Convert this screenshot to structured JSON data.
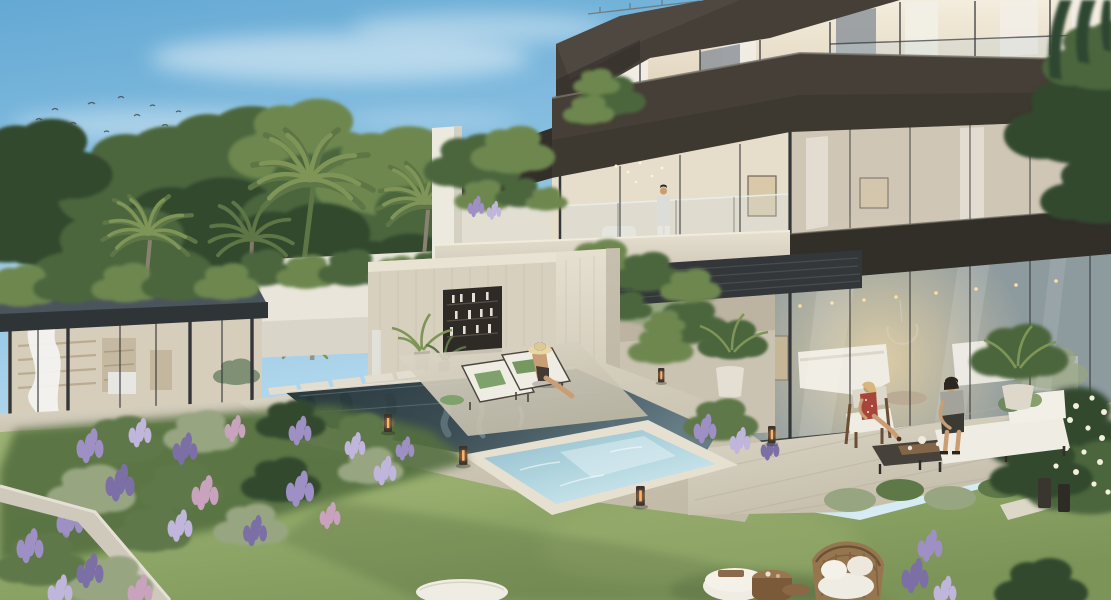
{
  "scene": {
    "description": "Dusk architectural rendering of a modern three-storey villa with floor-to-ceiling glazing and dark bronze fascia bands, a travertine pool house with display niche, a glass garden pavilion with billowing white curtain, a dark reflective pool, a raised light-blue jacuzzi, terraced lavender flower beds, manicured lawn and outdoor lounge furniture.",
    "setting": {
      "time_of_day": "dusk",
      "weather": "clear sky with thin cirrus clouds",
      "birds_in_sky": 13
    },
    "architecture": {
      "main_villa": {
        "floors": 3,
        "facade": "glass with dark bronze fascia bands",
        "interior_lights": "on",
        "middle_floor": "glass-railed balcony"
      },
      "pool_house": {
        "material": "travertine",
        "feature": "recessed shelving niche with bottles"
      },
      "portal": {
        "material": "travertine",
        "feature": "dark louvred canopy with climbing vine"
      },
      "garden_pavilion": {
        "type": "glass cabana",
        "roof": "dark flat slab",
        "detail": "white sheer curtain"
      }
    },
    "landscape": {
      "palm_trees": 6,
      "flower_beds": "lavender, sage and pink perennials in terraced concrete planters",
      "lawn": "manicured green",
      "corner_bush": "white frangipani"
    },
    "water_features": {
      "pool": "dark reflective pool with wall waterfall",
      "spa": "raised light-blue jacuzzi with steps"
    },
    "people": [
      {
        "label": "man standing on balcony"
      },
      {
        "label": "woman in straw hat on pool lounger"
      },
      {
        "label": "woman seated in patio armchair"
      },
      {
        "label": "man seated on patio sofa"
      }
    ],
    "furniture": {
      "sun_loungers": 2,
      "patio_set": "wood armchair, low table, cushioned sofa",
      "lawn_set": "rattan armchair, two wooden side tables, white pouf and ottoman"
    },
    "lighting": {
      "bollard_lights": 5,
      "candle_lantern": 1,
      "interior_downlights": "warm"
    }
  },
  "palette": {
    "sky_top": "#64a9d4",
    "sky_mid": "#9fcde8",
    "sky_horizon": "#d8edf5",
    "cloud": "#f7fbfd",
    "foliage_dark": "#32492e",
    "foliage": "#4c663c",
    "foliage_light": "#6d8750",
    "palm": "#5e7546",
    "palm_light": "#7f9557",
    "trunk": "#8b8173",
    "fascia": "#453f37",
    "fascia_dark": "#322e28",
    "mullion": "#34363a",
    "glass_warm": "#e9dfcc",
    "glass_cool": "#919da1",
    "curtain": "#f2efe7",
    "travertine": "#d7d0bf",
    "travertine_light": "#e6e0d1",
    "travertine_shadow": "#b9b19f",
    "deck": "#cfc9b8",
    "deck_shadow": "#b2ab99",
    "white_wall": "#e9e5da",
    "pool_deep": "#27363a",
    "pool": "#46585e",
    "pool_light": "#6d828a",
    "spa": "#aed2dc",
    "spa_light": "#d6eaf0",
    "lawn": "#8ca465",
    "lawn_light": "#9eb374",
    "lawn_dark": "#6e8550",
    "lavender": "#9e90c4",
    "lavender_light": "#c0b5da",
    "lavender_deep": "#7c6fa5",
    "pink": "#c9a3bd",
    "shrub": "#5f7848",
    "shrub_gray": "#97a681",
    "cushion": "#efece3",
    "wood": "#7e5e3e",
    "rattan": "#96764f",
    "skin": "#c99e74",
    "glow": "#ffc87a",
    "bird": "#44443e"
  }
}
